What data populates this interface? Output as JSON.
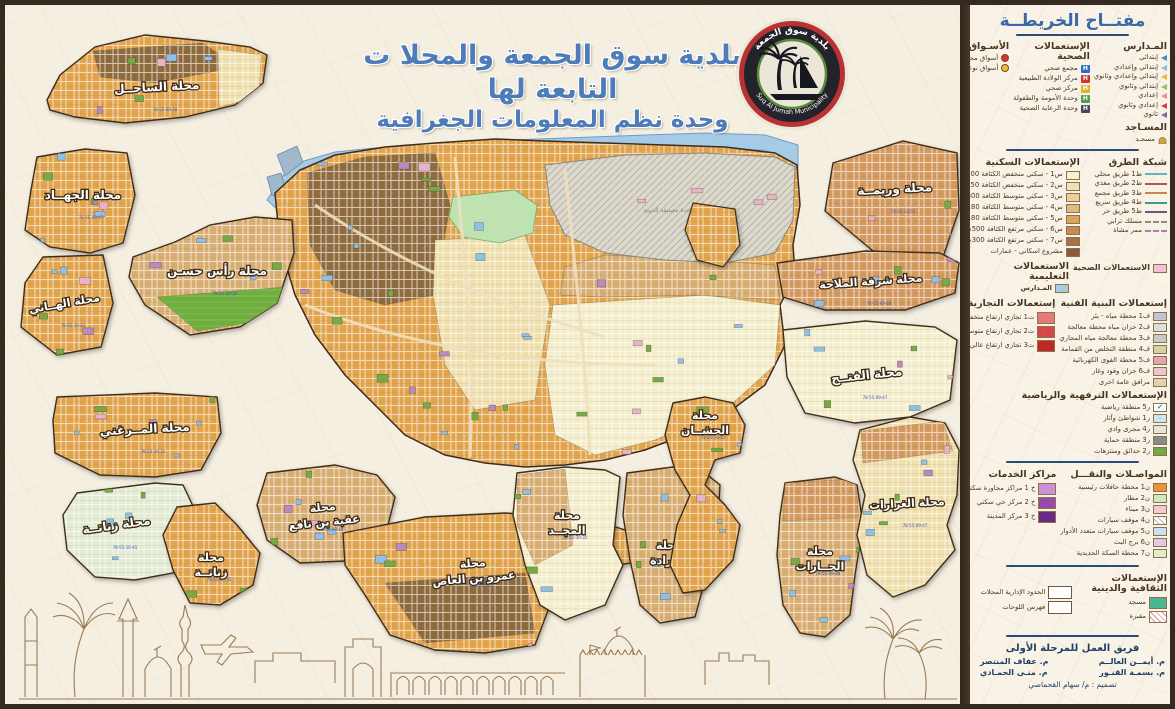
{
  "title": {
    "line1": "بلدية سوق الجمعة والمحلا ت التابعة لها",
    "line2": "وحدة نظم المعلومات الجغرافية"
  },
  "logo": {
    "name_ar": "بلدية سوق الجمعة",
    "name_en": "Suq Al Jumah Municipality"
  },
  "map": {
    "airbase_label": "قاعدة معيتيقة الجوية",
    "plate_numbers": [
      "78-55-09-48",
      "78-55-09-47",
      "78-55-10-32",
      "78-55-10-41",
      "78-55-10-55"
    ],
    "districts": [
      {
        "lines": [
          "محلة الساحــل"
        ]
      },
      {
        "lines": [
          "محلة الجهــاد"
        ]
      },
      {
        "lines": [
          "محلة رأس حسـن"
        ]
      },
      {
        "lines": [
          "محلة الهــاني"
        ]
      },
      {
        "lines": [
          "محلة وريمــة"
        ]
      },
      {
        "lines": [
          "محلة شرفة الملاحة"
        ]
      },
      {
        "lines": [
          "محلة الفتــح"
        ]
      },
      {
        "lines": [
          "محلة المــرغني"
        ]
      },
      {
        "lines": [
          "محلة زناتــة"
        ]
      },
      {
        "lines": [
          "محلة",
          "زناتــة"
        ]
      },
      {
        "lines": [
          "محلة",
          "عقبة بن نافع"
        ]
      },
      {
        "lines": [
          "محلة",
          "عمرو بن العاص"
        ]
      },
      {
        "lines": [
          "محلة",
          "المجــد"
        ]
      },
      {
        "lines": [
          "محلة",
          "عــرادة"
        ]
      },
      {
        "lines": [
          "محلة",
          "الحشــان"
        ]
      },
      {
        "lines": [
          "محلة",
          "الحــارات"
        ]
      },
      {
        "lines": [
          "محلة الغرارات"
        ]
      }
    ]
  },
  "legend": {
    "header": "مفتــاح الخريطــة",
    "schools": {
      "title": "المـدارس",
      "items": [
        {
          "label": "إبتدائي",
          "color": "#3f8fca"
        },
        {
          "label": "إبتدائي وإعدادي",
          "color": "#7fc3e0"
        },
        {
          "label": "إبتدائي وإعدادي وثانوي",
          "color": "#e8b93a"
        },
        {
          "label": "إبتدائي وثانوي",
          "color": "#8fbf6a"
        },
        {
          "label": "إعدادي",
          "color": "#e88aa8"
        },
        {
          "label": "إعدادي وثانوي",
          "color": "#cc4444"
        },
        {
          "label": "ثانوي",
          "color": "#8a5fa8"
        }
      ]
    },
    "health_facilities": {
      "title": "الإستعمالات الصحية",
      "items": [
        {
          "label": "مجمع صحي",
          "color": "#2f6fc0"
        },
        {
          "label": "مركز الولادة الطبيعية",
          "color": "#cc3333"
        },
        {
          "label": "مركز صحي",
          "color": "#e0b32e"
        },
        {
          "label": "وحدة الأمومة والطفولة",
          "color": "#4f9e4f"
        },
        {
          "label": "وحدة الرعاية الصحية",
          "color": "#444a5a"
        }
      ]
    },
    "markets": {
      "title": "الأسـواق",
      "items": [
        {
          "label": "أسواق مجمعة",
          "color": "#cc3333"
        },
        {
          "label": "أسواق نوعيـة",
          "color": "#e8c030"
        }
      ]
    },
    "mosques": {
      "title": "المسـاجد",
      "item": "مسجـد"
    },
    "roads": {
      "title": "شبكة الطرق",
      "items": [
        {
          "label": "ط1 طريق محلي",
          "color": "#5fb4c4"
        },
        {
          "label": "ط2 طريق مغذي",
          "color": "#b05555"
        },
        {
          "label": "ط3 طريق مجمع",
          "color": "#c8884a"
        },
        {
          "label": "ط4 طريق سريع",
          "color": "#3f9e86"
        },
        {
          "label": "ط5 طريق حر",
          "color": "#6a5a7a"
        },
        {
          "label": "مسلك ترابي",
          "color": "#9a8a74",
          "dash": true
        },
        {
          "label": "ممر مشاة",
          "color": "#a87fb0",
          "dash": true
        }
      ]
    },
    "residential": {
      "title": "الإستعمالات السكنية",
      "items": [
        {
          "label": "س1 - سكني منخفض الكثافة 500 م",
          "color": "#f8f1d0"
        },
        {
          "label": "س2 - سكني منخفض الكثافة 450م",
          "color": "#f2e2b2"
        },
        {
          "label": "س3 - سكني متوسط الكثافة 300م",
          "color": "#ecd096"
        },
        {
          "label": "س4 - سكني متوسط الكثافة 180م",
          "color": "#e4b878"
        },
        {
          "label": "س5 - سكني متوسط الكثافة 180م",
          "color": "#dca35c"
        },
        {
          "label": "س6 - سكني مرتفع الكثافة 500م",
          "color": "#c78c50"
        },
        {
          "label": "س7 - سكني مرتفع الكثافة 300م",
          "color": "#a87046"
        },
        {
          "label": "مشروع اسكاني - عمارات",
          "color": "#8a5a40"
        }
      ]
    },
    "health_use": {
      "label": "الاستعمالات الصحية",
      "color": "#f4c2d2"
    },
    "educational": {
      "title": "الاستعمالات التعليمية",
      "item": {
        "label": "المـدارس",
        "color": "#a9cde2"
      }
    },
    "commercial": {
      "title": "إستعمالات التجارية",
      "items": [
        {
          "label": "ت1 تجاري ارتفاع منخفض",
          "color": "#e87878"
        },
        {
          "label": "ت2 تجاري ارتفاع متوسط",
          "color": "#d94444"
        },
        {
          "label": "ت3 تجاري ارتفاع عالي",
          "color": "#c02828"
        }
      ]
    },
    "infrastructure": {
      "title": "إستعمالات البنية الفنية",
      "items": [
        {
          "label": "ف1 محطة مياه - بئر",
          "color": "#c2c6ce"
        },
        {
          "label": "ف2 خزان مياه محطة معالجة",
          "color": "#dcdee2"
        },
        {
          "label": "ف3 محطة معالجة مياه المجاري",
          "color": "#c6ccc0"
        },
        {
          "label": "ف4 منطقة التخلص من القمامة",
          "color": "#d6d2a2"
        },
        {
          "label": "ف5 محطة القوى الكهربائية",
          "color": "#e8a2aa"
        },
        {
          "label": "ف6 خزان وقود وغاز",
          "color": "#ecc4cc"
        },
        {
          "label": "مرافق عامة اخرى",
          "color": "#e2d2b2"
        }
      ]
    },
    "recreation": {
      "title": "الإستعمالات الترفهية والرياضية",
      "items": [
        {
          "label": "ر5 منطقة رياضية",
          "color": "#ffffff",
          "cls": "mark"
        },
        {
          "label": "ر1 شواطئ وآثار",
          "color": "#cfe3f2",
          "cls": "dots"
        },
        {
          "label": "ر4 مجرى وادي",
          "color": "#e6e4e0"
        },
        {
          "label": "ر3 منطقة حماية",
          "color": "#8a8a8a"
        },
        {
          "label": "ر2 حدائق ومنتزهات",
          "color": "#74a846"
        }
      ]
    },
    "transport": {
      "title": "المواصـلات والنقـــل",
      "items": [
        {
          "label": "ن1 محطة حافلات رئيسية",
          "color": "#f09030"
        },
        {
          "label": "ن2 مطار",
          "color": "#cfe8c2"
        },
        {
          "label": "ن3 ميناء",
          "color": "#f6c9d2"
        },
        {
          "label": "ن4 موقف سيارات",
          "color": "#ffffff",
          "cls": "xhatch"
        },
        {
          "label": "ن5 موقف سيارات متعدد الأدوار",
          "color": "#cce2f2"
        },
        {
          "label": "ن6 برج البث",
          "color": "#ddc9e8"
        },
        {
          "label": "ن7 محطة السكة الحديدية",
          "color": "#e3eec9"
        }
      ]
    },
    "services": {
      "title": "مراكز الخدمات",
      "items": [
        {
          "label": "خ 1 مراكز مجاورة سكنية",
          "color": "#cc8fd8"
        },
        {
          "label": "خ 2 مركز حي سكني",
          "color": "#9a49a8"
        },
        {
          "label": "خ 3 مركز المدينة",
          "color": "#6a2a82"
        }
      ]
    },
    "cultural": {
      "title": "الإستعمالات الثقافية والدينية",
      "items": [
        {
          "label": "مسجد",
          "color": "#49b890"
        },
        {
          "label": "مقبرة",
          "color": "#ffffff",
          "cls": "ghatch"
        }
      ]
    },
    "boundaries": {
      "items": [
        {
          "label": "الحدود الإدارية المحلات"
        },
        {
          "label": "فهرس اللوحات"
        }
      ]
    },
    "team": {
      "title": "فريق العمل للمرحلة الأولى",
      "members": [
        "م. أيمــن العالــم",
        "م. عفاف المنتصر",
        "م. بسمـة القنـور",
        "م. منـى الحمـادي"
      ],
      "design": "تصميم : م/ سهام القحماصي"
    }
  }
}
